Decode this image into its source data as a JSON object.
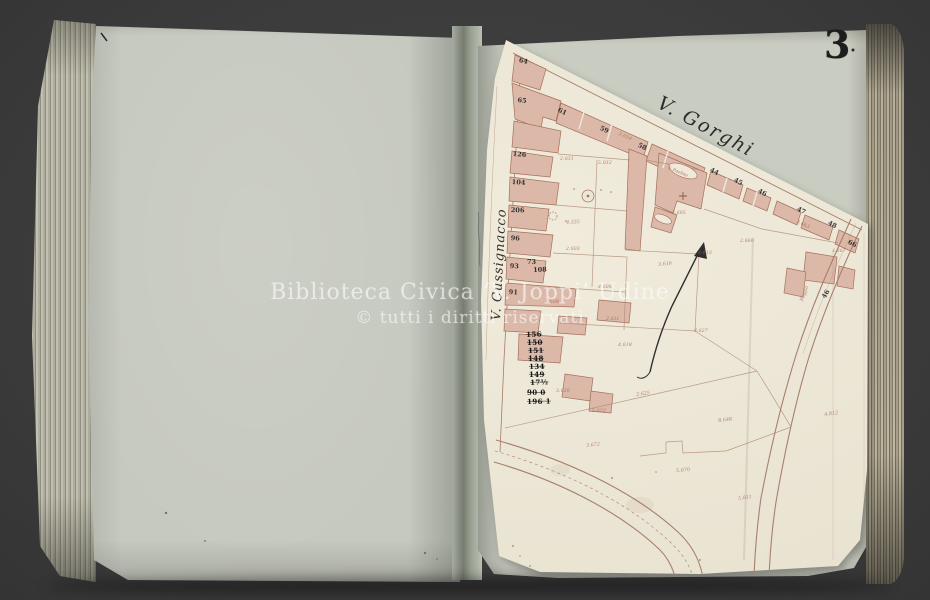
{
  "page": {
    "number": "3",
    "watermark_line1": "Biblioteca Civica ‘V. Joppi’ Udine",
    "watermark_line2": "© tutti i diritti riservati"
  },
  "map": {
    "street_gorghi": "V. Gorghi",
    "street_cussignacco": "V. Cussignacco",
    "church_label": "S. Paolino",
    "road_label": "Roggia",
    "parcel_labels": [
      {
        "t": "4.335",
        "x": 566,
        "y": 220,
        "r": -4
      },
      {
        "t": "2.031",
        "x": 560,
        "y": 156,
        "r": 0
      },
      {
        "t": "5.032",
        "x": 598,
        "y": 160,
        "r": 0
      },
      {
        "t": "3.034",
        "x": 620,
        "y": 131,
        "r": 25
      },
      {
        "t": "2.603",
        "x": 566,
        "y": 246,
        "r": 0
      },
      {
        "t": "2.605",
        "x": 672,
        "y": 210,
        "r": 0
      },
      {
        "t": "4.606",
        "x": 598,
        "y": 284,
        "r": 0
      },
      {
        "t": "3.608",
        "x": 545,
        "y": 299,
        "r": 0
      },
      {
        "t": "2.611",
        "x": 606,
        "y": 316,
        "r": 0
      },
      {
        "t": "3.616",
        "x": 658,
        "y": 262,
        "r": -6
      },
      {
        "t": "4.613",
        "x": 698,
        "y": 250,
        "r": 0
      },
      {
        "t": "4.618",
        "x": 618,
        "y": 342,
        "r": 0
      },
      {
        "t": "3.620",
        "x": 556,
        "y": 388,
        "r": 0
      },
      {
        "t": "5.622",
        "x": 592,
        "y": 408,
        "r": 0
      },
      {
        "t": "2.625",
        "x": 636,
        "y": 392,
        "r": -8
      },
      {
        "t": "4.627",
        "x": 694,
        "y": 328,
        "r": 0
      },
      {
        "t": "8.648",
        "x": 718,
        "y": 418,
        "r": -6
      },
      {
        "t": "2.660",
        "x": 740,
        "y": 238,
        "r": 0
      },
      {
        "t": "3.663",
        "x": 798,
        "y": 219,
        "r": 26
      },
      {
        "t": "4.667",
        "x": 832,
        "y": 248,
        "r": 0
      },
      {
        "t": "5.670",
        "x": 676,
        "y": 468,
        "r": -4
      },
      {
        "t": "3.672",
        "x": 586,
        "y": 443,
        "r": -6
      },
      {
        "t": "5.811",
        "x": 738,
        "y": 496,
        "r": -8
      },
      {
        "t": "4.812",
        "x": 824,
        "y": 412,
        "r": -8
      }
    ],
    "house_numbers": [
      {
        "t": "64",
        "x": 520,
        "y": 56,
        "r": 14
      },
      {
        "t": "65",
        "x": 518,
        "y": 96,
        "r": 6
      },
      {
        "t": "126",
        "x": 513,
        "y": 150,
        "r": 4
      },
      {
        "t": "104",
        "x": 512,
        "y": 178,
        "r": 3
      },
      {
        "t": "206",
        "x": 511,
        "y": 206,
        "r": 2
      },
      {
        "t": "96",
        "x": 511,
        "y": 234,
        "r": 4
      },
      {
        "t": "93",
        "x": 510,
        "y": 262,
        "r": 2
      },
      {
        "t": "91",
        "x": 509,
        "y": 288,
        "r": 3
      },
      {
        "t": "73",
        "x": 527,
        "y": 258,
        "r": 0
      },
      {
        "t": "108",
        "x": 533,
        "y": 266,
        "r": -2
      },
      {
        "t": "61",
        "x": 560,
        "y": 106,
        "r": 26
      },
      {
        "t": "59",
        "x": 602,
        "y": 124,
        "r": 26
      },
      {
        "t": "58",
        "x": 640,
        "y": 141,
        "r": 26
      },
      {
        "t": "44",
        "x": 712,
        "y": 166,
        "r": 26
      },
      {
        "t": "45",
        "x": 736,
        "y": 176,
        "r": 26
      },
      {
        "t": "46",
        "x": 760,
        "y": 187,
        "r": 26
      },
      {
        "t": "47",
        "x": 799,
        "y": 205,
        "r": 26
      },
      {
        "t": "48",
        "x": 830,
        "y": 219,
        "r": 26
      },
      {
        "t": "66",
        "x": 850,
        "y": 238,
        "r": 26
      },
      {
        "t": "46",
        "x": 820,
        "y": 296,
        "r": -60
      }
    ],
    "ledger_numbers": [
      {
        "t": "156",
        "x": 526,
        "y": 330,
        "r": -2
      },
      {
        "t": "150",
        "x": 527,
        "y": 338,
        "r": 0
      },
      {
        "t": "151",
        "x": 528,
        "y": 346,
        "r": -1
      },
      {
        "t": "148",
        "x": 528,
        "y": 354,
        "r": 0
      },
      {
        "t": "134",
        "x": 529,
        "y": 362,
        "r": -1
      },
      {
        "t": "149",
        "x": 529,
        "y": 370,
        "r": 0
      },
      {
        "t": "17½",
        "x": 530,
        "y": 378,
        "r": -2
      },
      {
        "t": "90 0",
        "x": 527,
        "y": 388,
        "r": 0
      },
      {
        "t": "196 1",
        "x": 527,
        "y": 397,
        "r": -1
      }
    ]
  }
}
